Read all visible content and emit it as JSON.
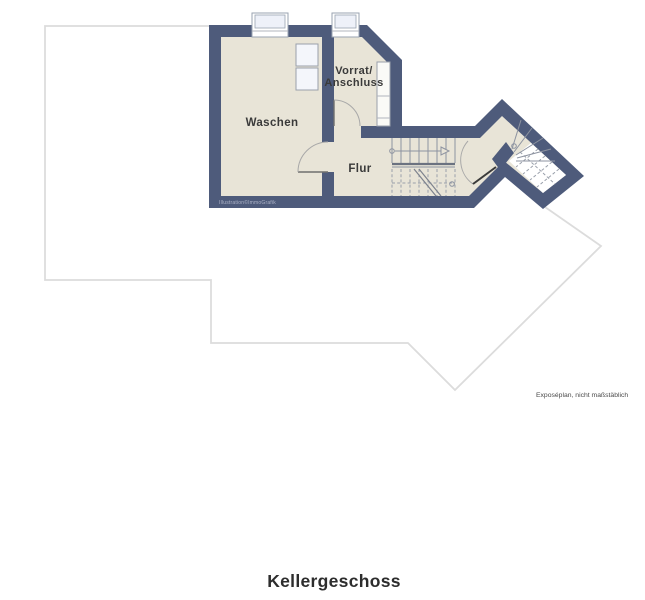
{
  "title": "Kellergeschoss",
  "disclaimer": "Exposéplan, nicht maßstäblich",
  "watermark": "Illustration©ImmoGrafik",
  "rooms": {
    "waschen": "Waschen",
    "vorrat_line1": "Vorrat/",
    "vorrat_line2": "Anschluss",
    "flur": "Flur"
  },
  "colors": {
    "wall": "#4e5b7b",
    "floor": "#e8e4d7",
    "upper_floor_outline": "#dcdcdc",
    "background": "#ffffff",
    "stair_lines": "#8d93a0",
    "label_text": "#3a3a3a"
  }
}
